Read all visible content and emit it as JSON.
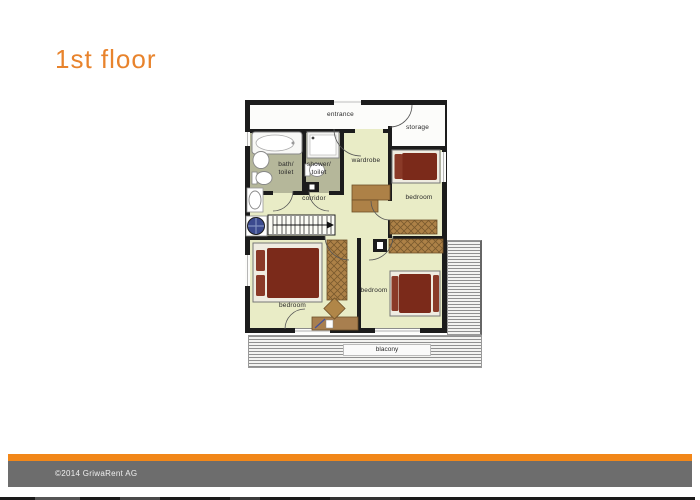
{
  "title": {
    "text": "1st floor"
  },
  "floorplan": {
    "rooms": {
      "entrance": "entrance",
      "storage": "storage",
      "bath_line1": "bath/",
      "bath_line2": "toilet",
      "shower_line1": "shower/",
      "shower_line2": "toilet",
      "wardrobe": "wardrobe",
      "corridor": "corridor",
      "bedroom_top_right": "bedroom",
      "bedroom_bottom_left": "bedroom",
      "bedroom_bottom_middle": "bedroom",
      "balcony": "blacony"
    },
    "colors": {
      "floor": "#e9ecc6",
      "wet_room": "#b5b79a",
      "wall": "#1c1c1c",
      "wood": "#ad8147",
      "bed": "#7b2a1a",
      "deck_line": "#909090"
    }
  },
  "footer": {
    "copyright": "©2014 GriwaRent AG",
    "bar_color": "#f28718",
    "band_color": "#6d6d6d"
  }
}
